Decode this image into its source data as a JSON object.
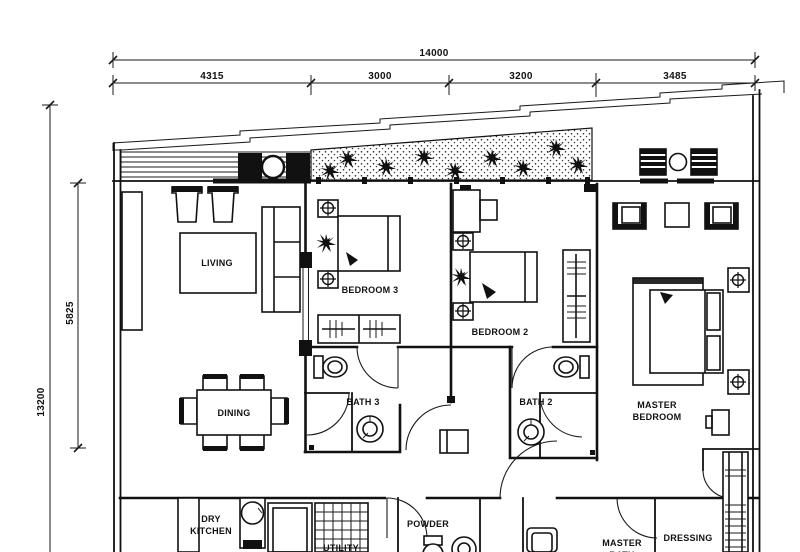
{
  "title": "apartment-floor-plan",
  "style": {
    "ink": "#1a1a1a",
    "paper": "#ffffff"
  },
  "dimensions": {
    "overall_width": "14000",
    "width_segments": [
      "4315",
      "3000",
      "3200",
      "3485"
    ],
    "overall_height": "13200",
    "height_segment": "5825"
  },
  "rooms": {
    "living": "LIVING",
    "dining": "DINING",
    "dry_kitchen": [
      "DRY",
      "KITCHEN"
    ],
    "bedroom3": "BEDROOM 3",
    "bedroom2": "BEDROOM 2",
    "master_bedroom": [
      "MASTER",
      "BEDROOM"
    ],
    "bath3": "BATH 3",
    "bath2": "BATH 2",
    "powder": "POWDER",
    "utility": "UTILITY",
    "master_bath": [
      "MASTER",
      "BATH"
    ],
    "dressing": "DRESSING"
  }
}
